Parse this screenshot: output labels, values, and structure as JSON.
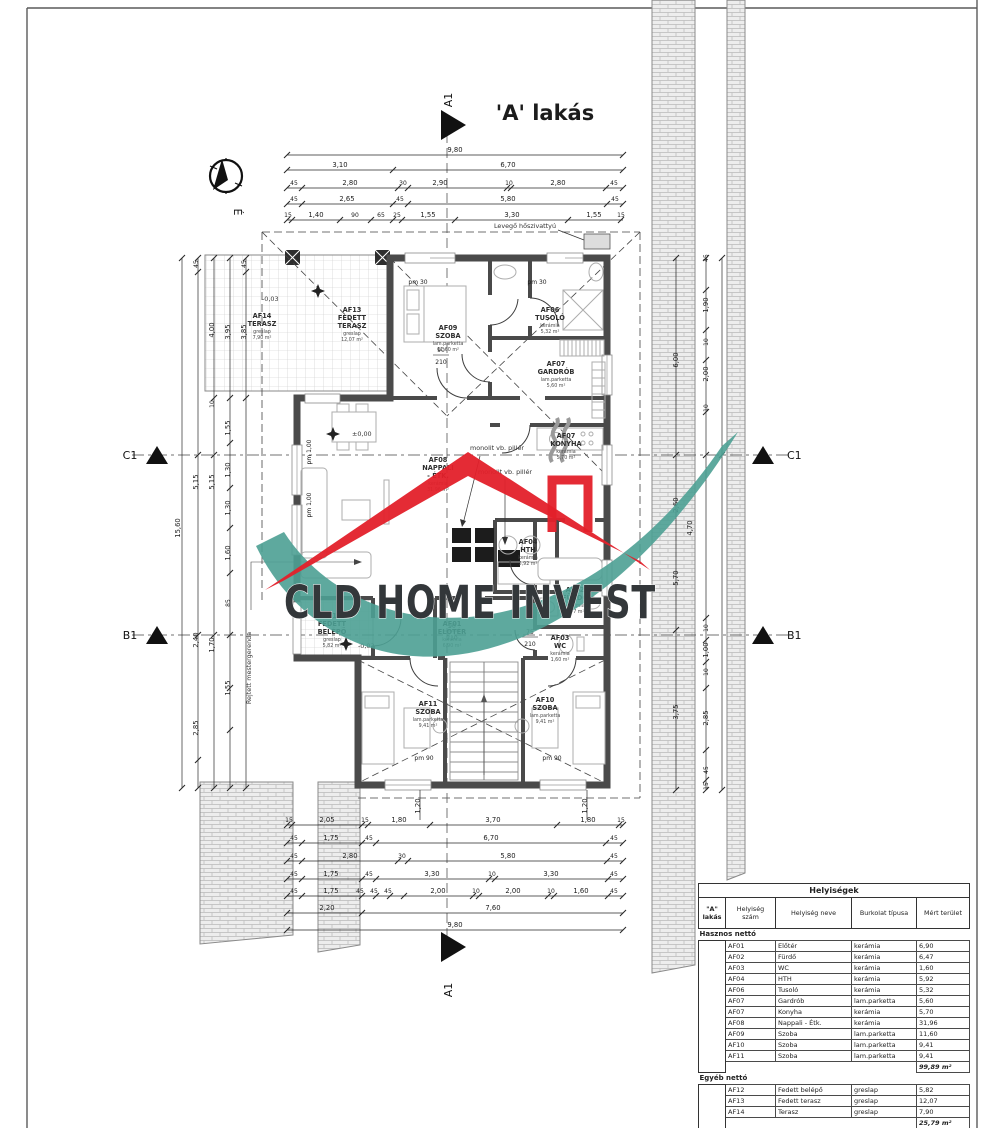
{
  "title": "'A' lakás",
  "logo": {
    "text": "CLD HOME INVEST",
    "red": "#e3202a",
    "teal": "#4da093",
    "dark": "#33373a"
  },
  "markers": {
    "a1": "A1",
    "b1": "B1",
    "c1": "C1",
    "north": "É"
  },
  "annotations": {
    "pillar": "monolit vb. pillér",
    "pillar2": "monolit vb. pillér",
    "heat_pump": "Levegő hőszivattyú",
    "beam": "Rejtett mestergerenda",
    "lvl0": "±0,00",
    "lvlm": "-0,03",
    "pm30": "pm 30",
    "pm90": "pm 90",
    "pm100": "pm 1,00"
  },
  "rooms": [
    {
      "id": "AF14",
      "n1": "TERASZ",
      "n2": "",
      "mat": "greslap",
      "area": "7,90 m²"
    },
    {
      "id": "AF13",
      "n1": "FEDETT",
      "n2": "TERASZ",
      "mat": "greslap",
      "area": "12,07 m²"
    },
    {
      "id": "AF09",
      "n1": "SZOBA",
      "n2": "",
      "mat": "lam.parketta",
      "area": "11,60 m²"
    },
    {
      "id": "AF06",
      "n1": "TUSOLÓ",
      "n2": "",
      "mat": "kerámia",
      "area": "5,32 m²"
    },
    {
      "id": "AF07",
      "n1": "GARDRÓB",
      "n2": "",
      "mat": "lam.parketta",
      "area": "5,60 m²"
    },
    {
      "id": "AF07",
      "n1": "KONYHA",
      "n2": "",
      "mat": "kerámia",
      "area": "5,70 m²"
    },
    {
      "id": "AF08",
      "n1": "NAPPALI",
      "n2": "- ÉTK.",
      "mat": "kerámia",
      "area": "31,96 m²"
    },
    {
      "id": "AF04",
      "n1": "HTH",
      "n2": "",
      "mat": "kerámia",
      "area": "5,92 m²"
    },
    {
      "id": "AF02",
      "n1": "FÜRDŐ",
      "n2": "",
      "mat": "kerámia",
      "area": "6,47 m²"
    },
    {
      "id": "AF01",
      "n1": "ELŐTÉR",
      "n2": "",
      "mat": "kerámia",
      "area": "6,90 m²"
    },
    {
      "id": "AF03",
      "n1": "WC",
      "n2": "",
      "mat": "kerámia",
      "area": "1,60 m²"
    },
    {
      "id": "AF12",
      "n1": "FEDETT",
      "n2": "BELÉPŐ",
      "mat": "greslap",
      "area": "5,82 m²"
    },
    {
      "id": "AF11",
      "n1": "SZOBA",
      "n2": "",
      "mat": "lam.parketta",
      "area": "9,41 m²"
    },
    {
      "id": "AF10",
      "n1": "SZOBA",
      "n2": "",
      "mat": "lam.parketta",
      "area": "9,41 m²"
    }
  ],
  "dims": {
    "top": [
      [
        "9,80"
      ],
      [
        "3,10",
        "6,70"
      ],
      [
        "45",
        "2,80",
        "30",
        "2,90",
        "10",
        "2,80",
        "45"
      ],
      [
        "45",
        "2,65",
        "45",
        "5,80",
        "45"
      ],
      [
        "15",
        "1,40",
        "90",
        "65",
        "25",
        "1,55",
        "3,30",
        "1,55",
        "15"
      ]
    ],
    "bottom": [
      [
        "15",
        "2,05",
        "15",
        "1,80",
        "3,70",
        "1,80",
        "15"
      ],
      [
        "45",
        "1,75",
        "45",
        "6,70",
        "45"
      ],
      [
        "45",
        "2,80",
        "30",
        "5,80",
        "45"
      ],
      [
        "45",
        "1,75",
        "45",
        "3,30",
        "10",
        "3,30",
        "45"
      ],
      [
        "45",
        "1,75",
        "45",
        "45",
        "45",
        "2,00",
        "10",
        "2,00",
        "10",
        "1,60",
        "45"
      ],
      [
        "2,20",
        "7,60"
      ],
      [
        "9,80"
      ]
    ],
    "left": [
      "15,60",
      "45",
      "5,15",
      "2,40",
      "2,85",
      "4,00",
      "10",
      "5,15",
      "1,70",
      "3,95",
      "1,55",
      "1,30",
      "1,30",
      "1,60",
      "85",
      "1,55",
      "45",
      "3,85"
    ],
    "right": [
      "45",
      "1,90",
      "10",
      "2,00",
      "10",
      "6,00",
      "2,60",
      "4,70",
      "5,70",
      "10",
      "1,00",
      "10",
      "3,75",
      "2,85",
      "45",
      "15"
    ],
    "below": [
      "1,20",
      "1,20"
    ],
    "doors": [
      "90",
      "210",
      "90",
      "210",
      "75",
      "210"
    ]
  },
  "table": {
    "title": "Helyiségek",
    "col_a_1": "\"A\"",
    "col_a_2": "lakás",
    "col_num": "Helyiség szám",
    "col_name": "Helyiség neve",
    "col_type": "Burkolat típusa",
    "col_area": "Mért terület",
    "sec1": "Hasznos nettó",
    "sec2": "Egyéb nettó",
    "rows1": [
      [
        "AF01",
        "Előtér",
        "kerámia",
        "6,90"
      ],
      [
        "AF02",
        "Fürdő",
        "kerámia",
        "6,47"
      ],
      [
        "AF03",
        "WC",
        "kerámia",
        "1,60"
      ],
      [
        "AF04",
        "HTH",
        "kerámia",
        "5,92"
      ],
      [
        "AF06",
        "Tusoló",
        "kerámia",
        "5,32"
      ],
      [
        "AF07",
        "Gardrób",
        "lam.parketta",
        "5,60"
      ],
      [
        "AF07",
        "Konyha",
        "kerámia",
        "5,70"
      ],
      [
        "AF08",
        "Nappali - Étk.",
        "kerámia",
        "31,96"
      ],
      [
        "AF09",
        "Szoba",
        "lam.parketta",
        "11,60"
      ],
      [
        "AF10",
        "Szoba",
        "lam.parketta",
        "9,41"
      ],
      [
        "AF11",
        "Szoba",
        "lam.parketta",
        "9,41"
      ]
    ],
    "sum1": "99,89 m²",
    "rows2": [
      [
        "AF12",
        "Fedett belépő",
        "greslap",
        "5,82"
      ],
      [
        "AF13",
        "Fedett terasz",
        "greslap",
        "12,07"
      ],
      [
        "AF14",
        "Terasz",
        "greslap",
        "7,90"
      ]
    ],
    "sum2": "25,79 m²",
    "total": "125,68 m²"
  }
}
